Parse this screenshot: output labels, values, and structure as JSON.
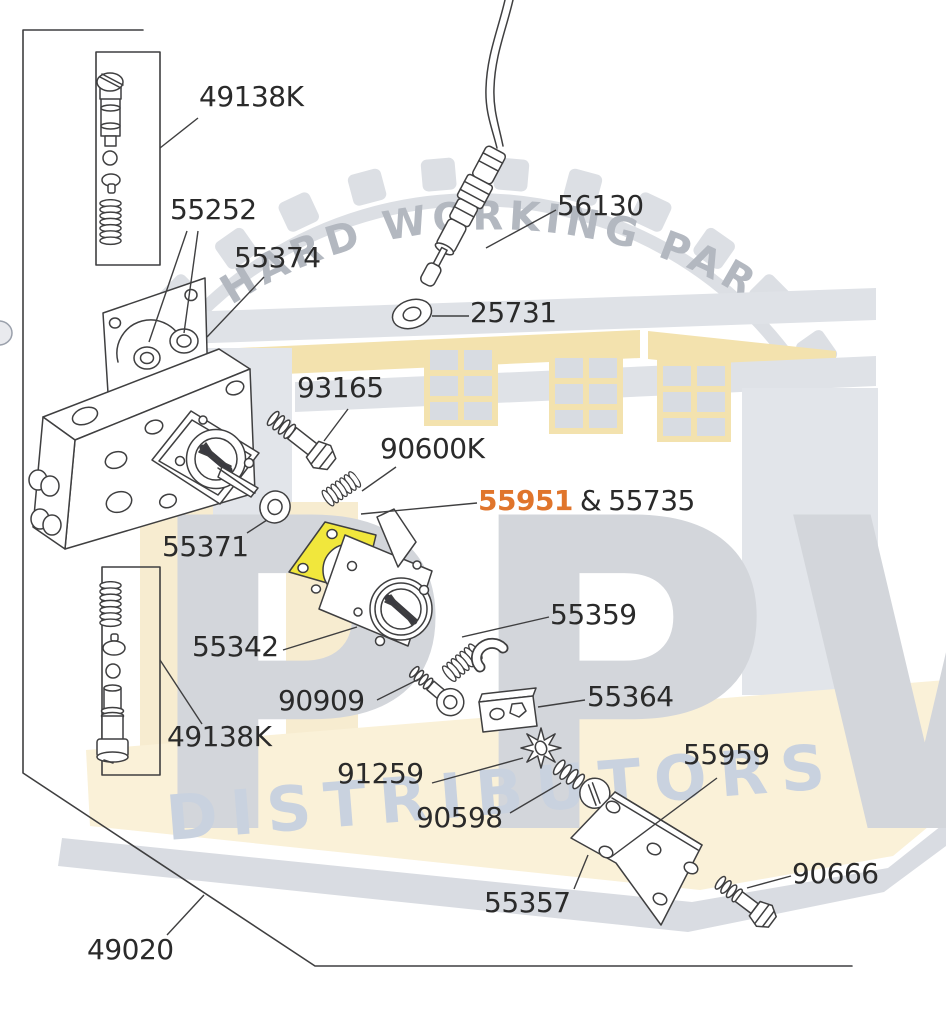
{
  "watermark": {
    "arc_text": "HARD WORKING PARTS",
    "brand": "PPW",
    "banner": "DISTRIBUTORS",
    "colors": {
      "cream": "#F7ECD0",
      "band": "#FAF1D8",
      "building_gray": "#DFE2E7",
      "brand_letters": "#D3D6DB",
      "banner_text": "#C9D2DF",
      "arc_text_color": "#B3B8C0"
    }
  },
  "diagram": {
    "labels": [
      {
        "part": "valve-kit-top",
        "text": "49138K"
      },
      {
        "part": "gasket-rings",
        "text": "55252"
      },
      {
        "part": "pump-plate",
        "text": "55374"
      },
      {
        "part": "throttle-cable",
        "text": "56130"
      },
      {
        "part": "washer",
        "text": "25731"
      },
      {
        "part": "hex-bolt-upper",
        "text": "93165"
      },
      {
        "part": "spring-small",
        "text": "90600K"
      },
      {
        "part": "seal-washer",
        "text": "55371"
      },
      {
        "part": "carburetor-body",
        "text": "55342"
      },
      {
        "part": "spring-clip",
        "text": "55359"
      },
      {
        "part": "socket-screw",
        "text": "90909"
      },
      {
        "part": "spacer-block",
        "text": "55364"
      },
      {
        "part": "valve-kit-bottom",
        "text": "49138K"
      },
      {
        "part": "star-washer",
        "text": "91259"
      },
      {
        "part": "slotted-screw",
        "text": "90598"
      },
      {
        "part": "bracket-rear",
        "text": "55959"
      },
      {
        "part": "bracket-front",
        "text": "55357"
      },
      {
        "part": "hex-bolt-lower",
        "text": "90666"
      },
      {
        "part": "main-assembly",
        "text": "49020"
      }
    ],
    "highlight_label": {
      "number": "55951",
      "separator": "&",
      "companion": "55735"
    },
    "colors": {
      "highlight_fill": "#F1E73C",
      "highlight_text": "#E0752C",
      "line": "#3F3F40",
      "text": "#2A2A2A"
    }
  }
}
